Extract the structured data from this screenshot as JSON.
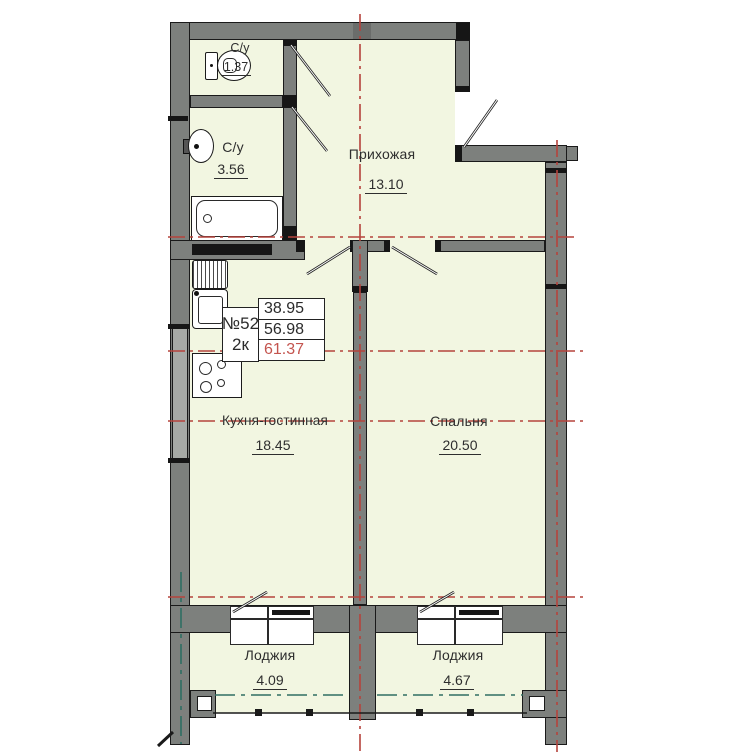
{
  "unit_card": {
    "number": "№52",
    "type": "2к",
    "areas": [
      "38.95",
      "56.98",
      "61.37"
    ]
  },
  "rooms": [
    {
      "label": "С/у",
      "area": "1.37"
    },
    {
      "label": "С/у",
      "area": "3.56"
    },
    {
      "label": "Прихожая",
      "area": "13.10"
    },
    {
      "label": "Кухня-гостинная",
      "area": "18.45"
    },
    {
      "label": "Спальня",
      "area": "20.50"
    },
    {
      "label": "Лоджия",
      "area": "4.09"
    },
    {
      "label": "Лоджия",
      "area": "4.67"
    }
  ],
  "fixtures": [
    "toilet-icon",
    "sink-icon",
    "bathtub-icon",
    "kitchen-sink-icon",
    "stove-icon"
  ],
  "colors": {
    "room_fill": "#f2f6e1",
    "wall_gray": "#7d807d",
    "axis_red": "#b5433c",
    "glazing_teal": "#2f6f63",
    "total_area_red": "#c4544e"
  }
}
